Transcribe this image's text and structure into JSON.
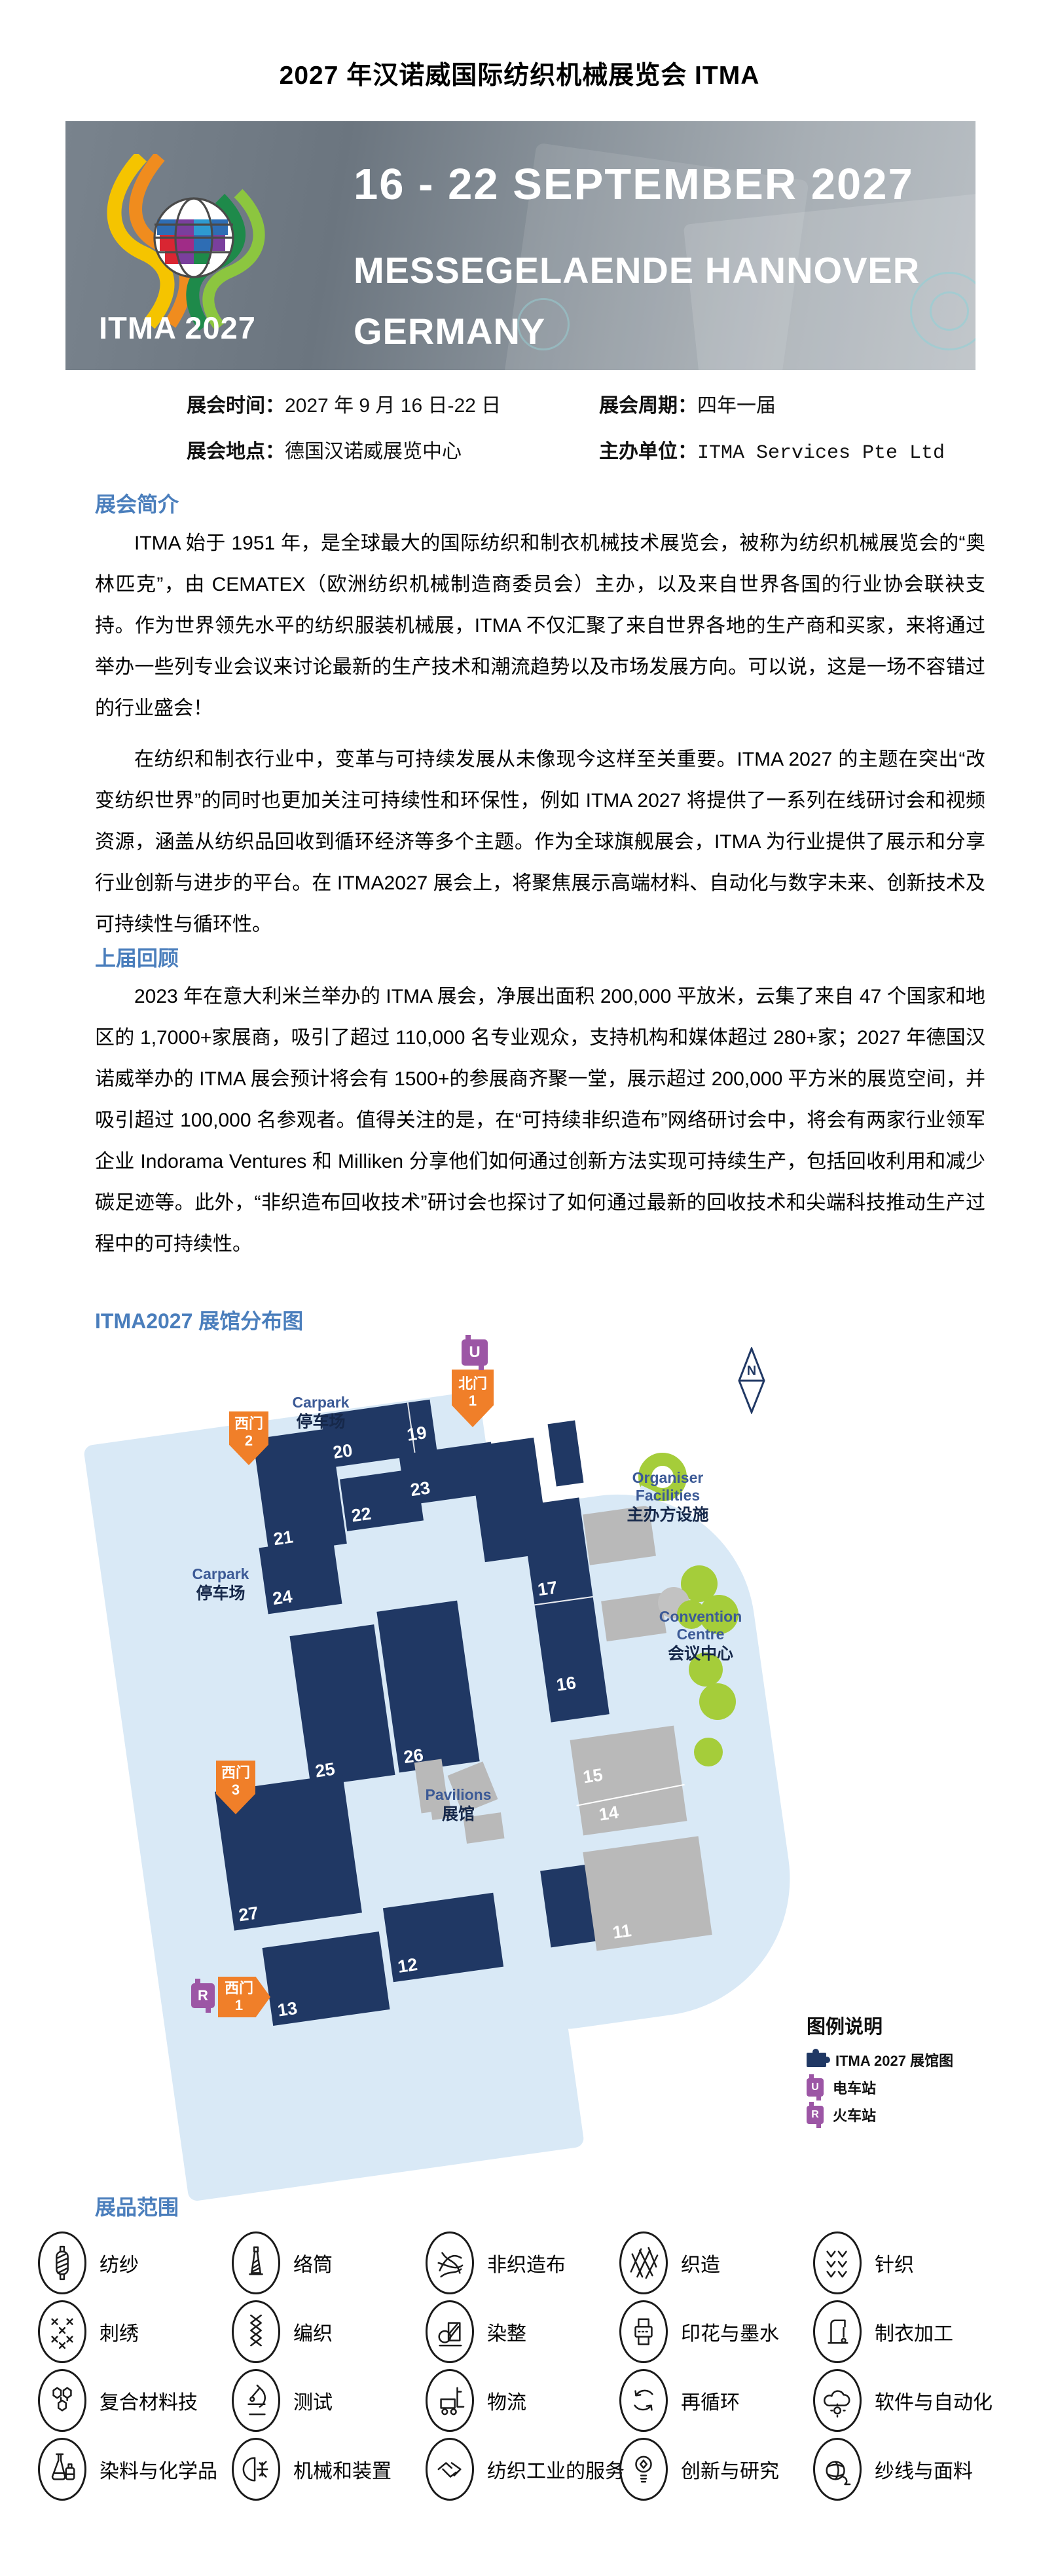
{
  "page": {
    "title": "2027 年汉诺威国际纺织机械展览会 ITMA"
  },
  "banner": {
    "dates": "16 - 22 SEPTEMBER 2027",
    "venue1": "MESSEGELAENDE HANNOVER",
    "venue2": "GERMANY",
    "logo_text": "ITMA 2027"
  },
  "info": {
    "rows": [
      {
        "label": "展会时间：",
        "value": "2027 年 9 月 16 日-22 日"
      },
      {
        "label": "展会周期：",
        "value": "四年一届"
      },
      {
        "label": "展会地点：",
        "value": "德国汉诺威展览中心"
      },
      {
        "label": "主办单位：",
        "value": "ITMA Services Pte Ltd"
      }
    ]
  },
  "sections": {
    "intro": {
      "heading": "展会简介",
      "paragraphs": [
        "ITMA 始于 1951 年，是全球最大的国际纺织和制衣机械技术展览会，被称为纺织机械展览会的“奥林匹克”，由 CEMATEX（欧洲纺织机械制造商委员会）主办，以及来自世界各国的行业协会联袂支持。作为世界领先水平的纺织服装机械展，ITMA 不仅汇聚了来自世界各地的生产商和买家，来将通过举办一些列专业会议来讨论最新的生产技术和潮流趋势以及市场发展方向。可以说，这是一场不容错过的行业盛会！",
        "在纺织和制衣行业中，变革与可持续发展从未像现今这样至关重要。ITMA 2027 的主题在突出“改变纺织世界”的同时也更加关注可持续性和环保性，例如 ITMA 2027 将提供了一系列在线研讨会和视频资源，涵盖从纺织品回收到循环经济等多个主题。作为全球旗舰展会，ITMA 为行业提供了展示和分享行业创新与进步的平台。在 ITMA2027 展会上，将聚焦展示高端材料、自动化与数字未来、创新技术及可持续性与循环性。"
      ]
    },
    "review": {
      "heading": "上届回顾",
      "paragraphs": [
        "2023 年在意大利米兰举办的 ITMA 展会，净展出面积 200,000 平放米，云集了来自 47 个国家和地区的 1,7000+家展商，吸引了超过 110,000 名专业观众，支持机构和媒体超过 280+家；2027 年德国汉诺威举办的 ITMA 展会预计将会有 1500+的参展商齐聚一堂，展示超过 200,000 平方米的展览空间，并吸引超过 100,000 名参观者。值得关注的是，在“可持续非织造布”网络研讨会中，将会有两家行业领军企业 Indorama Ventures 和 Milliken 分享他们如何通过创新方法实现可持续生产，包括回收利用和减少碳足迹等。此外，“非织造布回收技术”研讨会也探讨了如何通过最新的回收技术和尖端科技推动生产过程中的可持续性。"
      ]
    },
    "map": {
      "heading": "ITMA2027 展馆分布图",
      "compass_n": "N",
      "carpark_en": "Carpark",
      "carpark_zh": "停车场",
      "organiser": {
        "en1": "Organiser",
        "en2": "Facilities",
        "zh": "主办方设施"
      },
      "convention": {
        "en1": "Convention",
        "en2": "Centre",
        "zh": "会议中心"
      },
      "pavilions": {
        "en": "Pavilions",
        "zh": "展馆"
      },
      "gates": [
        {
          "line1": "北门",
          "line2": "1"
        },
        {
          "line1": "西门",
          "line2": "2"
        },
        {
          "line1": "西门",
          "line2": "3"
        },
        {
          "line1": "西门",
          "line2": "1"
        }
      ],
      "stations": {
        "tram_letter": "U",
        "train_letter": "R"
      },
      "halls_navy": [
        "19",
        "20",
        "21",
        "22",
        "23",
        "24",
        "25",
        "26",
        "27",
        "13",
        "12",
        "17",
        "16"
      ],
      "halls_gray": [
        "15",
        "14",
        "11"
      ],
      "legend": {
        "title": "图例说明",
        "items": [
          {
            "icon": "puzzle-icon",
            "label": "ITMA 2027 展馆图"
          },
          {
            "icon": "tram-icon",
            "label": "电车站"
          },
          {
            "icon": "train-icon",
            "label": "火车站"
          }
        ]
      },
      "colors": {
        "hall": "#203864",
        "ground": "#d9e9f6",
        "gate": "#f07f29",
        "station": "#9c56a5",
        "green": "#a5cd3a",
        "gray": "#b9b9b9"
      }
    },
    "scope": {
      "heading": "展品范围",
      "items": [
        {
          "icon": "spinning-icon",
          "label": "纺纱"
        },
        {
          "icon": "winding-icon",
          "label": "络筒"
        },
        {
          "icon": "nonwovens-icon",
          "label": "非织造布"
        },
        {
          "icon": "weaving-icon",
          "label": "织造"
        },
        {
          "icon": "knitting-icon",
          "label": "针织"
        },
        {
          "icon": "embroidery-icon",
          "label": "刺绣"
        },
        {
          "icon": "braiding-icon",
          "label": "编织"
        },
        {
          "icon": "finishing-icon",
          "label": "染整"
        },
        {
          "icon": "printing-icon",
          "label": "印花与墨水"
        },
        {
          "icon": "garment-icon",
          "label": "制衣加工"
        },
        {
          "icon": "composites-icon",
          "label": "复合材料技"
        },
        {
          "icon": "testing-icon",
          "label": "测试"
        },
        {
          "icon": "logistics-icon",
          "label": "物流"
        },
        {
          "icon": "recycling-icon",
          "label": "再循环"
        },
        {
          "icon": "software-icon",
          "label": "软件与自动化"
        },
        {
          "icon": "chemicals-icon",
          "label": "染料与化学品"
        },
        {
          "icon": "machinery-icon",
          "label": "机械和装置"
        },
        {
          "icon": "services-icon",
          "label": "纺织工业的服务"
        },
        {
          "icon": "innovation-icon",
          "label": "创新与研究"
        },
        {
          "icon": "yarns-icon",
          "label": "纱线与面料"
        }
      ]
    }
  },
  "accent_colors": {
    "heading_blue": "#4a7ebc"
  }
}
